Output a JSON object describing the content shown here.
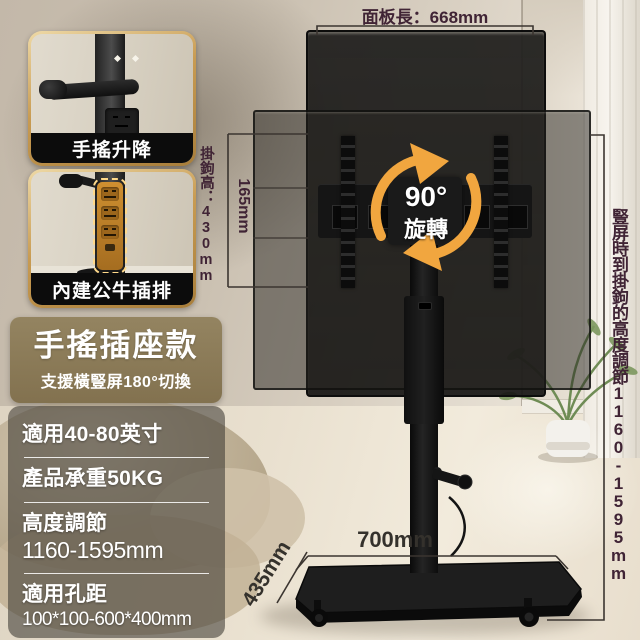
{
  "product_annotations": {
    "panel_length": "面板長：668mm",
    "hook_height": "掛鉤高：430mm",
    "hook_offset": "165mm",
    "rotation_angle": "90°",
    "rotation_label": "旋轉",
    "side_height_note": "豎屏時到掛鉤的高度調節1160-1595mm",
    "base_width": "700mm",
    "base_depth": "435mm"
  },
  "insets": [
    {
      "caption": "手搖升降"
    },
    {
      "caption": "內建公牛插排"
    }
  ],
  "title_card": {
    "title": "手搖插座款",
    "subtitle": "支援橫豎屏180°切換"
  },
  "specs": [
    {
      "line1": "適用40-80英寸",
      "line2": ""
    },
    {
      "line1": "產品承重50KG",
      "line2": ""
    },
    {
      "line1": "高度調節",
      "line2": "1160-1595mm"
    },
    {
      "line1": "適用孔距",
      "line2": "100*100-600*400mm"
    }
  ],
  "colors": {
    "annotation_text": "#402435",
    "dimension_text": "#34312c",
    "accent_orange": "#f1a63f",
    "title_card_bg": "#8b7a56",
    "gold_border": "#c89b52",
    "caption_bg": "#0c0c0c",
    "spec_panel_bg": "rgba(62,58,52,0.58)"
  }
}
